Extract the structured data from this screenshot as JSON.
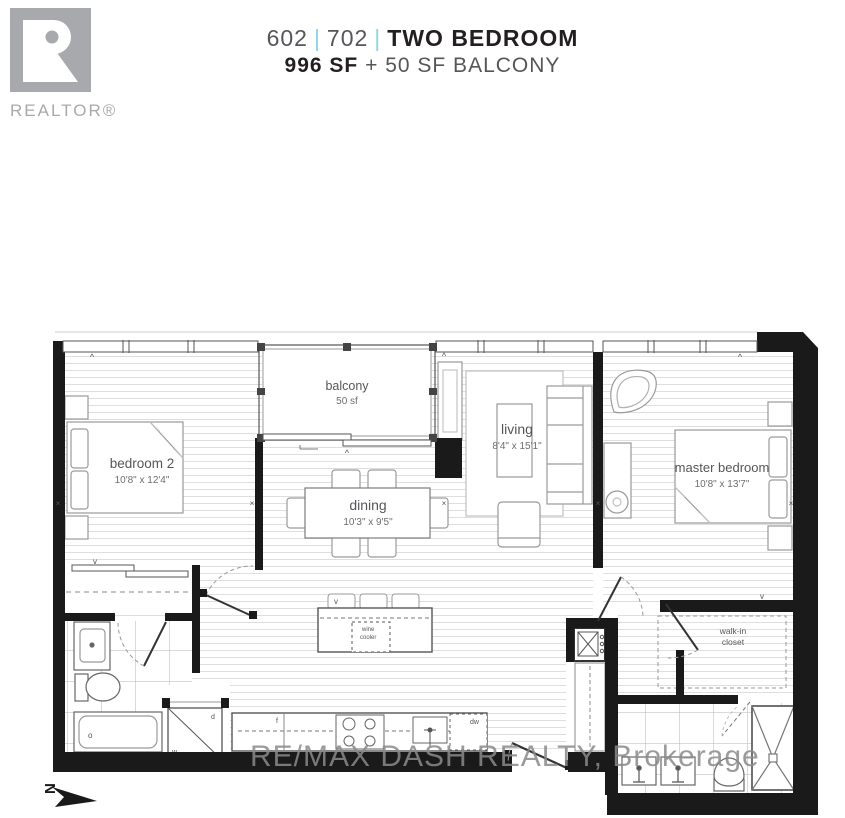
{
  "header": {
    "brand": "REALTOR®",
    "unit_a": "602",
    "unit_b": "702",
    "separator": "|",
    "plan_type": "TWO BEDROOM",
    "area_main": "996 SF",
    "area_suffix": " + 50 SF BALCONY",
    "accent_color": "#90d5e8"
  },
  "plan": {
    "rooms": {
      "bedroom2": {
        "name": "bedroom 2",
        "dims": "10'8\" x 12'4\""
      },
      "balcony": {
        "name": "balcony",
        "dims": "50 sf"
      },
      "dining": {
        "name": "dining",
        "dims": "10'3\" x 9'5\""
      },
      "living": {
        "name": "living",
        "dims": "8'4\" x 15'1\""
      },
      "master": {
        "name": "master bedroom",
        "dims": "10'8\" x 13'7\""
      },
      "walkin_l1": "walk-in",
      "walkin_l2": "closet"
    },
    "fixtures": {
      "fridge": "f",
      "dishwasher": "dw",
      "washer": "w",
      "dryer": "d",
      "tub_drain": "o",
      "wine_l1": "wine",
      "wine_l2": "cooler"
    },
    "marks": {
      "x": "×",
      "vent": "^",
      "v": "v"
    },
    "compass": "N",
    "wall_color": "#1a1a1a"
  },
  "watermark": "RE/MAX DASH REALTY, Brokerage"
}
